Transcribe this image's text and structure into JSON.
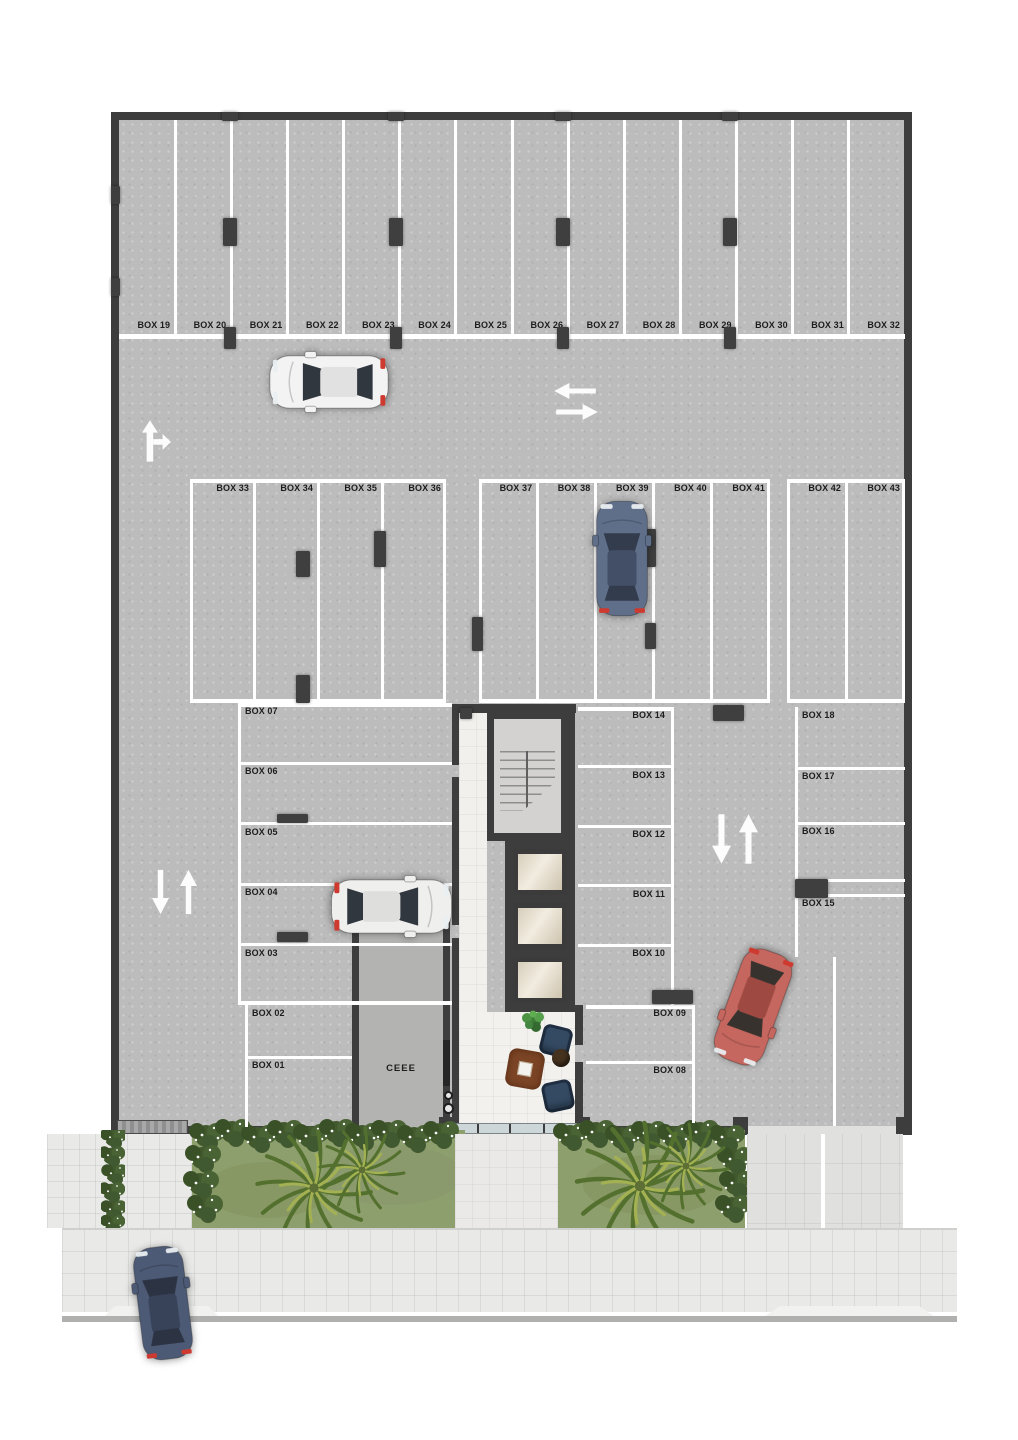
{
  "floor_plan": {
    "stalls": {
      "top": [
        "BOX 19",
        "BOX 20",
        "BOX 21",
        "BOX 22",
        "BOX 23",
        "BOX 24",
        "BOX 25",
        "BOX 26",
        "BOX 27",
        "BOX 28",
        "BOX 29",
        "BOX 30",
        "BOX 31",
        "BOX 32"
      ],
      "mid_left": [
        "BOX 33",
        "BOX 34",
        "BOX 35",
        "BOX 36"
      ],
      "mid_center": [
        "BOX 37",
        "BOX 38",
        "BOX 39",
        "BOX 40",
        "BOX 41"
      ],
      "mid_right": [
        "BOX 42",
        "BOX 43"
      ],
      "west": [
        "BOX 07",
        "BOX 06",
        "BOX 05",
        "BOX 04",
        "BOX 03"
      ],
      "west_lower": [
        "BOX 02",
        "BOX 01"
      ],
      "center": [
        "BOX 14",
        "BOX 13",
        "BOX 12",
        "BOX 11",
        "BOX 10"
      ],
      "center_lower": [
        "BOX 09",
        "BOX 08"
      ],
      "east": [
        "BOX 18",
        "BOX 17",
        "BOX 16",
        "BOX 15"
      ]
    },
    "rooms": {
      "electrical": "CEEE"
    },
    "cars": [
      {
        "id": "white-sedan-top-aisle",
        "body": "#f3f3f3",
        "roof": "#e1e1e1",
        "glass": "#31373e"
      },
      {
        "id": "white-hatchback-box04",
        "body": "#efefee",
        "roof": "#dededd",
        "glass": "#31373e"
      },
      {
        "id": "blue-suv-box39",
        "body": "#5f6f8a",
        "roof": "#434f66",
        "glass": "#333c4d"
      },
      {
        "id": "red-car-exit-lane",
        "body": "#c6675f",
        "roof": "#9e4a43",
        "glass": "#38322f"
      },
      {
        "id": "blue-car-street",
        "body": "#4d5a75",
        "roof": "#38435a",
        "glass": "#2c3443"
      }
    ],
    "colors": {
      "floor": "#bcbcbc",
      "walls": "#3d3d3d",
      "marking": "#ffffff",
      "label_text": "#1d1d1d",
      "grass": "#8e9f6e",
      "bush": "#42592e",
      "sidewalk": "#e9e9e8",
      "lobby_floor": "#f1f0ed",
      "elevator_cab": "#d8cfbd",
      "ceee_floor": "#b3b3b2"
    },
    "icons": [
      "up-arrow-icon",
      "down-arrow-icon",
      "left-arrow-icon",
      "right-arrow-icon",
      "straight-or-right-arrow-icon",
      "palm-tree-icon",
      "bush-icon",
      "stairs-icon",
      "elevator-icon",
      "armchair-icon",
      "rug-icon",
      "ottoman-icon",
      "plant-icon",
      "car-icon"
    ]
  }
}
